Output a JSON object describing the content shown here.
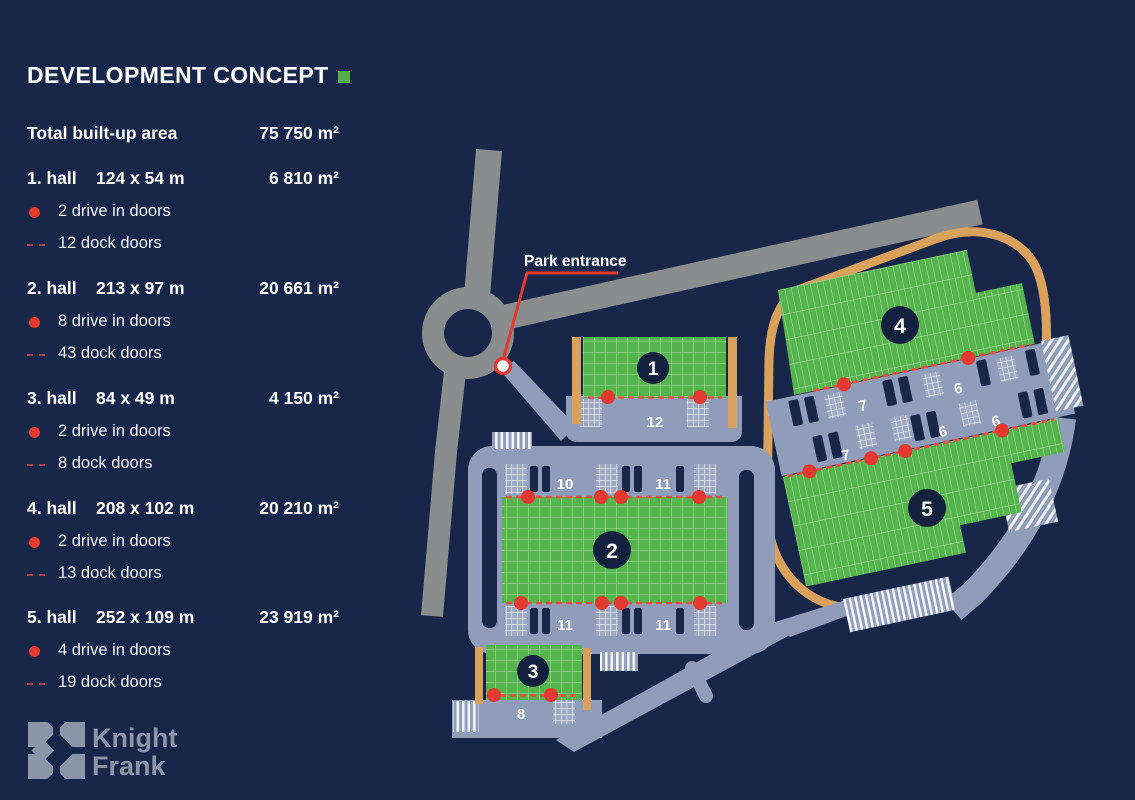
{
  "header": {
    "title": "DEVELOPMENT CONCEPT"
  },
  "summary": {
    "label": "Total built-up area",
    "value": "75 750 m²"
  },
  "halls": [
    {
      "name": "1. hall",
      "dimensions": "124 x 54 m",
      "area": "6 810 m²",
      "drive_in_doors": "2 drive in doors",
      "dock_doors": "12 dock doors"
    },
    {
      "name": "2. hall",
      "dimensions": "213 x 97 m",
      "area": "20 661 m²",
      "drive_in_doors": "8 drive in doors",
      "dock_doors": "43 dock doors"
    },
    {
      "name": "3. hall",
      "dimensions": "84 x 49 m",
      "area": "4 150 m²",
      "drive_in_doors": "2 drive in doors",
      "dock_doors": "8 dock doors"
    },
    {
      "name": "4. hall",
      "dimensions": "208 x 102 m",
      "area": "20 210 m²",
      "drive_in_doors": "2 drive in doors",
      "dock_doors": "13 dock doors"
    },
    {
      "name": "5. hall",
      "dimensions": "252 x 109 m",
      "area": "23 919 m²",
      "drive_in_doors": "4 drive in doors",
      "dock_doors": "19 dock doors"
    }
  ],
  "map": {
    "park_entrance_label": "Park entrance",
    "hall_markers": {
      "h1": "1",
      "h2": "2",
      "h3": "3",
      "h4": "4",
      "h5": "5"
    },
    "dock_counts": {
      "h1": "12",
      "h2_top_left": "10",
      "h2_top_right": "11",
      "h2_bottom_left": "11",
      "h2_bottom_right": "11",
      "h3": "8",
      "h4_left": "7",
      "h4_right": "6",
      "h5_left": "7",
      "h5_mid": "6",
      "h5_right": "6"
    }
  },
  "logo": {
    "line1": "Knight",
    "line2": "Frank"
  },
  "colors": {
    "background": "#172649",
    "building_green": "#56B44E",
    "accent_red": "#E23A30",
    "apron_slate": "#8F9DBA",
    "road_gray": "#8A8D8D",
    "boundary_orange": "#D9A15B",
    "marker_navy": "#13203E"
  }
}
